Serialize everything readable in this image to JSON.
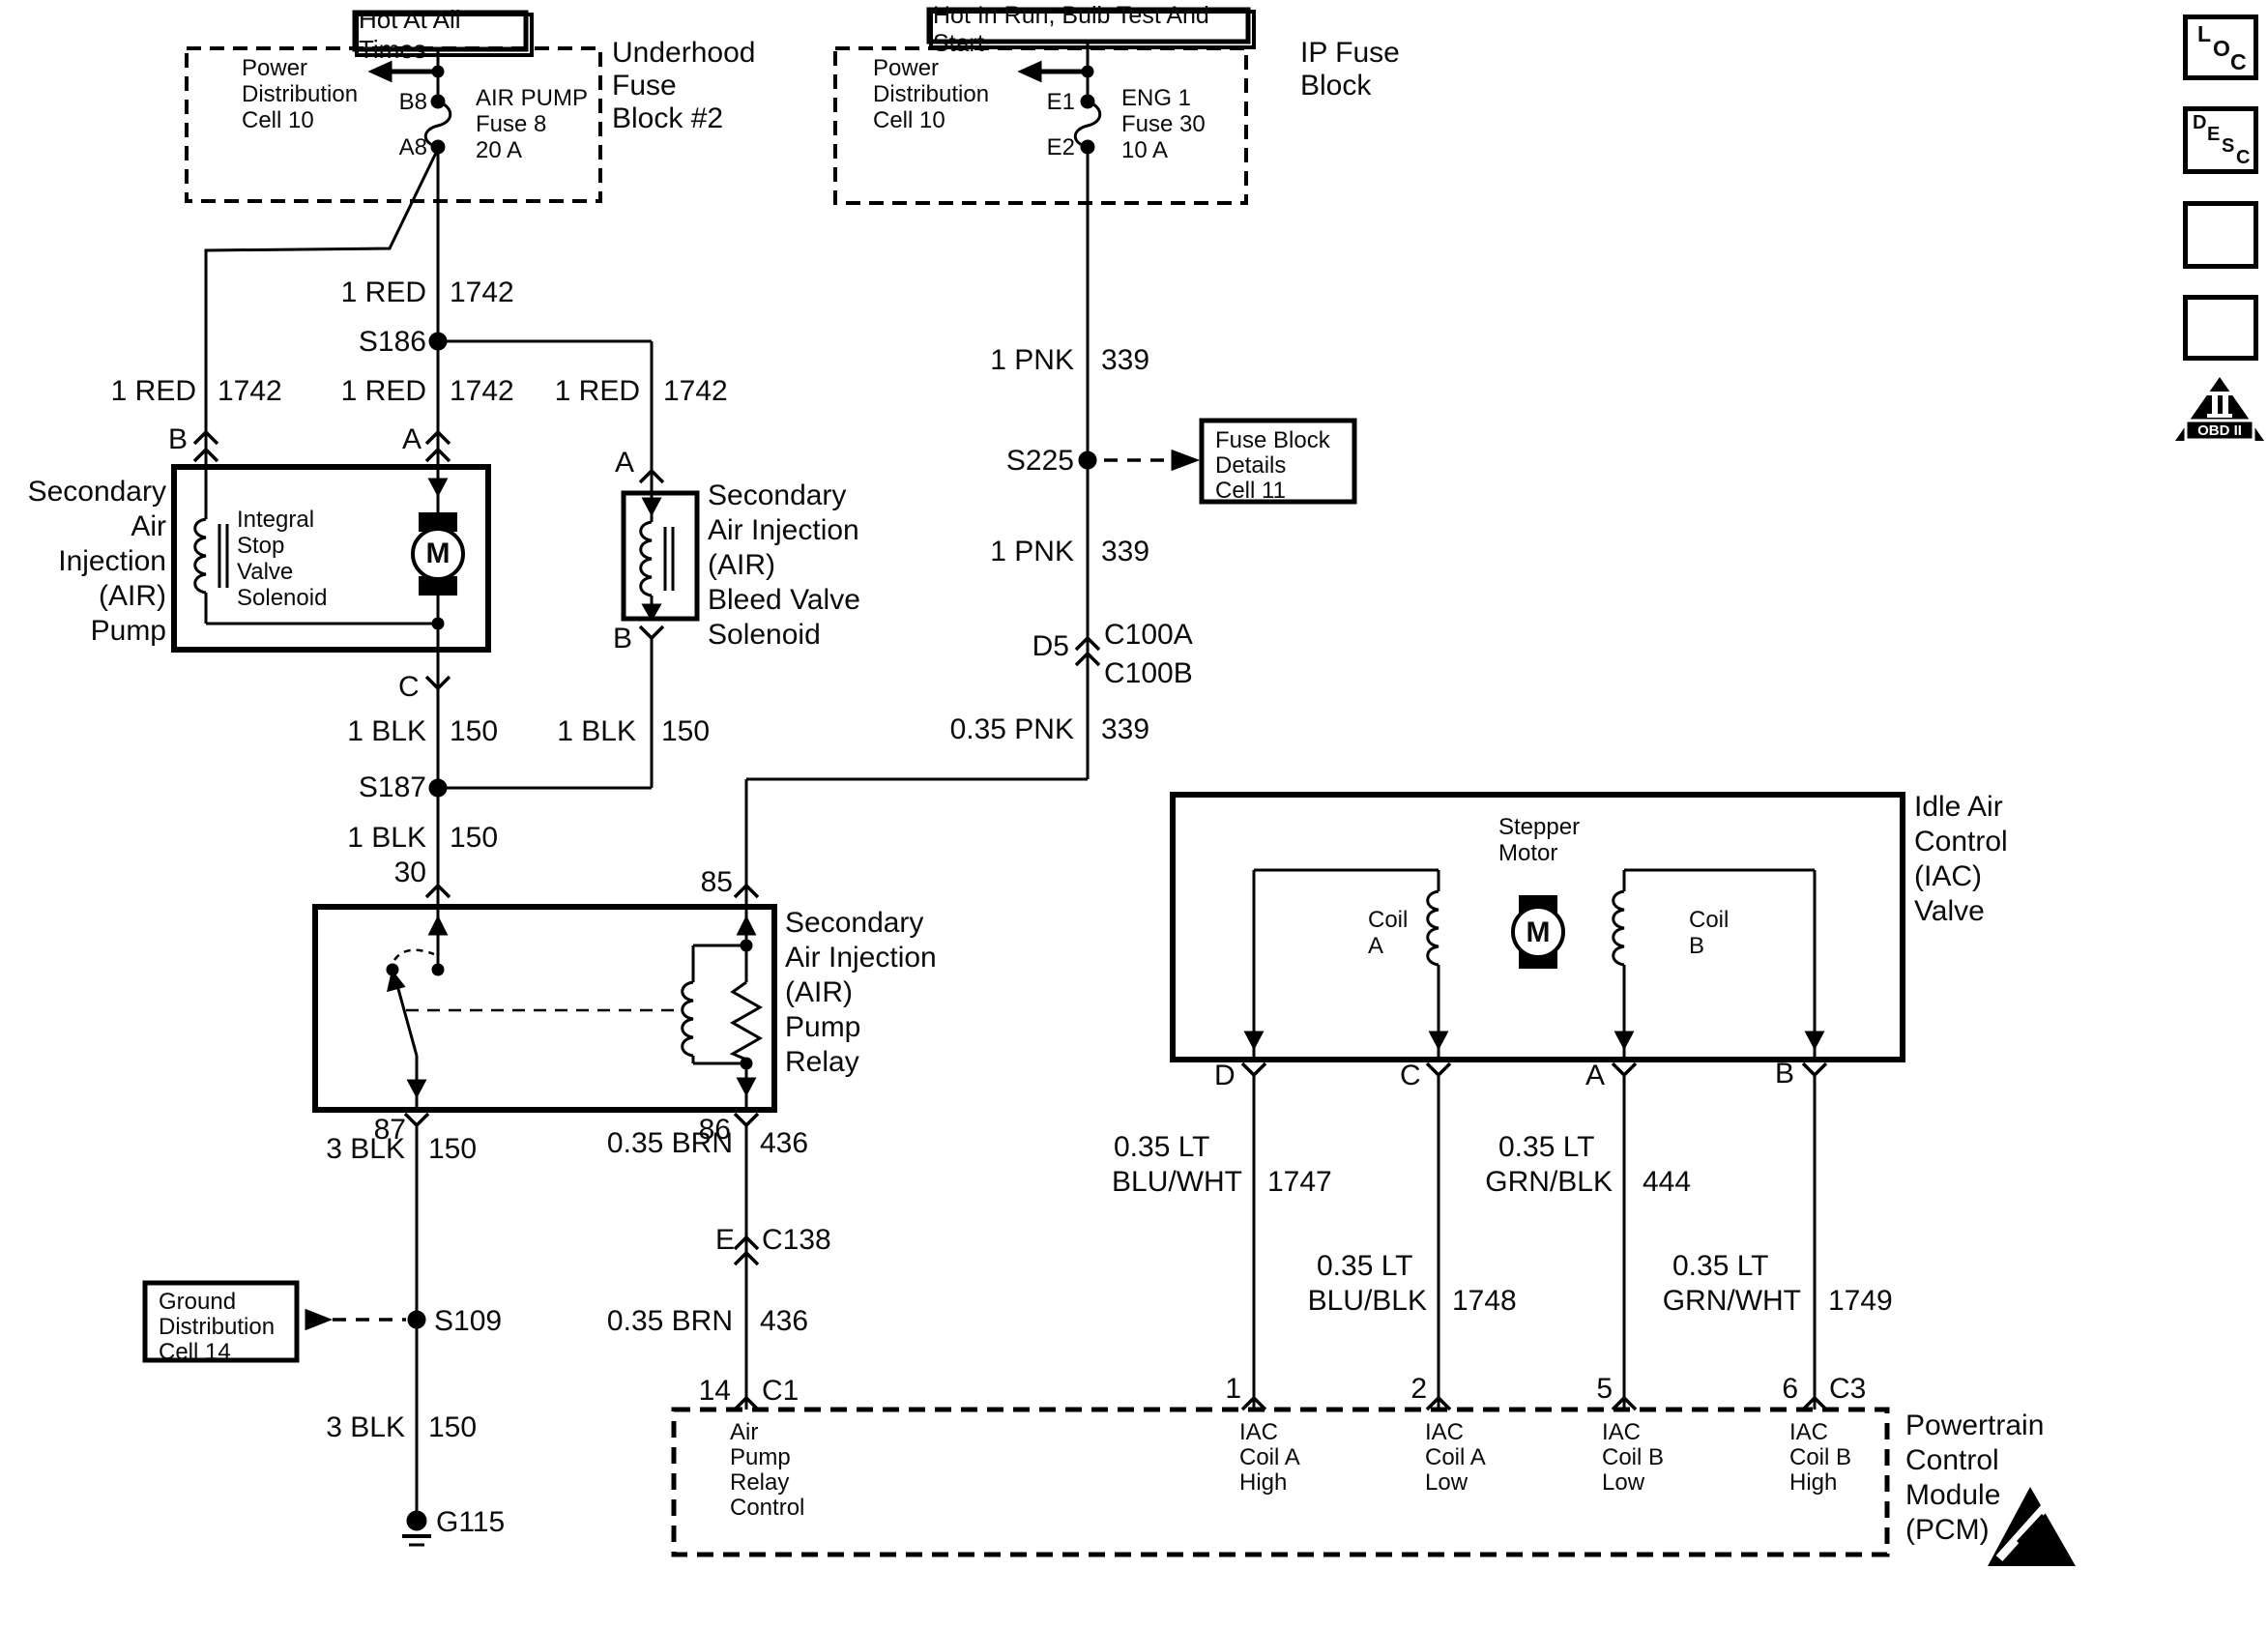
{
  "title": "Secondary Air Injection / Idle Air Control wiring diagram",
  "colors": {
    "wire": "#000000",
    "background": "#ffffff"
  },
  "underhood_feed": {
    "hot_label": "Hot At All Times",
    "block_label": [
      "Underhood",
      "Fuse",
      "Block #2"
    ],
    "power_dist": [
      "Power",
      "Distribution",
      "Cell 10"
    ],
    "pin_top": "B8",
    "pin_bottom": "A8",
    "fuse": [
      "AIR PUMP",
      "Fuse 8",
      "20 A"
    ]
  },
  "ip_feed": {
    "hot_label": "Hot In Run, Bulb Test And Start",
    "block_label": [
      "IP Fuse",
      "Block"
    ],
    "power_dist": [
      "Power",
      "Distribution",
      "Cell 10"
    ],
    "pin_top": "E1",
    "pin_bottom": "E2",
    "fuse": [
      "ENG 1",
      "Fuse 30",
      "10 A"
    ]
  },
  "wires": {
    "lt_prefix": "0.35 LT",
    "red": {
      "name": "1 RED",
      "code": "1742"
    },
    "blk1": {
      "name": "1 BLK",
      "code": "150"
    },
    "blk3": {
      "name": "3 BLK",
      "code": "150"
    },
    "pnk1": {
      "name": "1 PNK",
      "code": "339"
    },
    "pnk035": {
      "name": "0.35 PNK",
      "code": "339"
    },
    "brn": {
      "name": "0.35 BRN",
      "code": "436"
    },
    "blu_wht": {
      "name": "BLU/WHT",
      "code": "1747"
    },
    "blu_blk": {
      "name": "BLU/BLK",
      "code": "1748"
    },
    "grn_blk": {
      "name": "GRN/BLK",
      "code": "444"
    },
    "grn_wht": {
      "name": "GRN/WHT",
      "code": "1749"
    }
  },
  "splices": {
    "s186": "S186",
    "s187": "S187",
    "s225": "S225",
    "s109": "S109"
  },
  "ground": {
    "g115": "G115"
  },
  "connectors": {
    "d5": "D5",
    "c100a": "C100A",
    "c100b": "C100B",
    "e": "E",
    "c138": "C138"
  },
  "ref_boxes": {
    "fuse_block_details": [
      "Fuse Block",
      "Details",
      "Cell 11"
    ],
    "ground_dist": [
      "Ground",
      "Distribution",
      "Cell 14"
    ]
  },
  "pump": {
    "label": [
      "Secondary",
      "Air",
      "Injection",
      "(AIR)",
      "Pump"
    ],
    "solenoid": [
      "Integral",
      "Stop",
      "Valve",
      "Solenoid"
    ],
    "motor": "M",
    "pin_b": "B",
    "pin_a": "A",
    "pin_c": "C"
  },
  "bleed": {
    "label": [
      "Secondary",
      "Air Injection",
      "(AIR)",
      "Bleed Valve",
      "Solenoid"
    ],
    "pin_a": "A",
    "pin_b": "B"
  },
  "relay": {
    "label": [
      "Secondary",
      "Air Injection",
      "(AIR)",
      "Pump",
      "Relay"
    ],
    "p30": "30",
    "p85": "85",
    "p87": "87",
    "p86": "86"
  },
  "iac": {
    "label": [
      "Idle Air",
      "Control",
      "(IAC)",
      "Valve"
    ],
    "stepper": [
      "Stepper",
      "Motor"
    ],
    "motor": "M",
    "coil_a": [
      "Coil",
      "A"
    ],
    "coil_b": [
      "Coil",
      "B"
    ],
    "pins": [
      "D",
      "C",
      "A",
      "B"
    ]
  },
  "pcm": {
    "label": [
      "Powertrain",
      "Control",
      "Module",
      "(PCM)"
    ],
    "pins": {
      "p14": "14",
      "c1": "C1",
      "p1": "1",
      "p2": "2",
      "p5": "5",
      "p6": "6",
      "c3": "C3"
    },
    "air_pump_relay_control": [
      "Air",
      "Pump",
      "Relay",
      "Control"
    ],
    "iac_a_high": [
      "IAC",
      "Coil A",
      "High"
    ],
    "iac_a_low": [
      "IAC",
      "Coil A",
      "Low"
    ],
    "iac_b_low": [
      "IAC",
      "Coil B",
      "Low"
    ],
    "iac_b_high": [
      "IAC",
      "Coil B",
      "High"
    ]
  },
  "icons": {
    "loc": [
      "L",
      "O",
      "C"
    ],
    "desc": [
      "D",
      "E",
      "S",
      "C"
    ],
    "obd_numeral": "II",
    "obd_label": "OBD II"
  }
}
